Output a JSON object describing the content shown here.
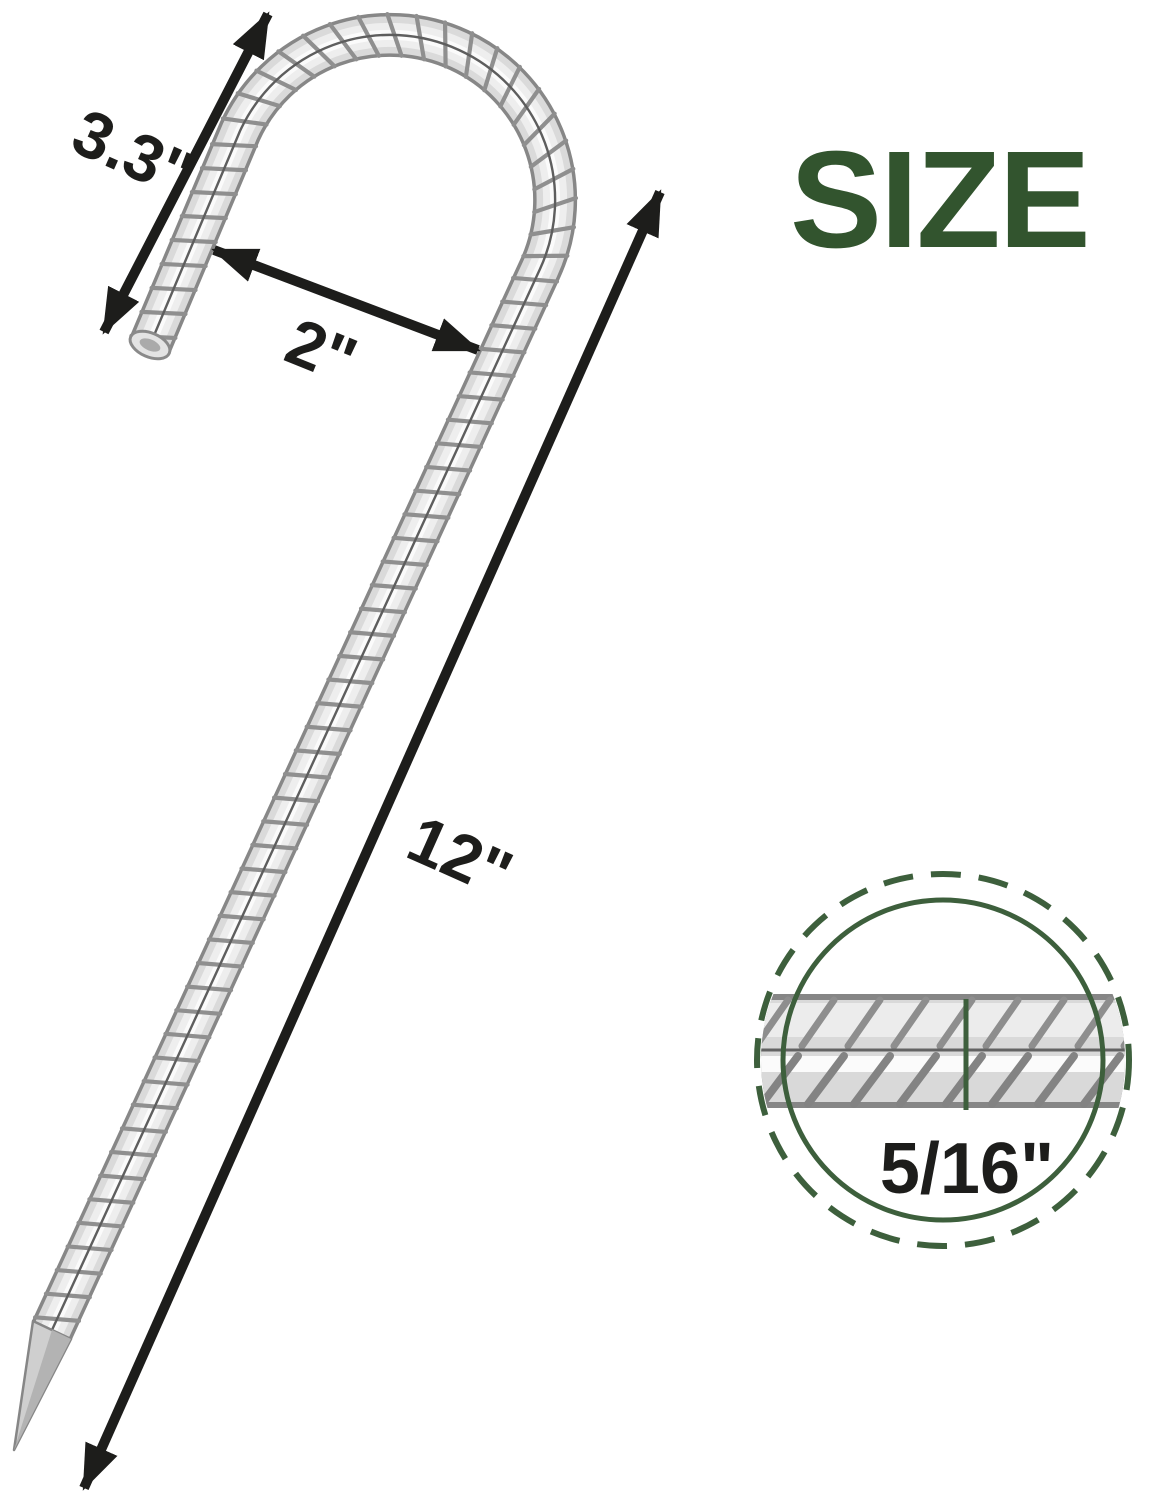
{
  "page": {
    "background": "#ffffff"
  },
  "title": {
    "label": "SIZE",
    "color": "#32542e"
  },
  "annotations": {
    "hook_height": "3.3\"",
    "hook_inner_width": "2\"",
    "stake_length": "12\"",
    "rebar_diameter": "5/16\"",
    "color": "#1d1d1b"
  },
  "detail_circle": {
    "outline_color": "#3d5f3c"
  }
}
